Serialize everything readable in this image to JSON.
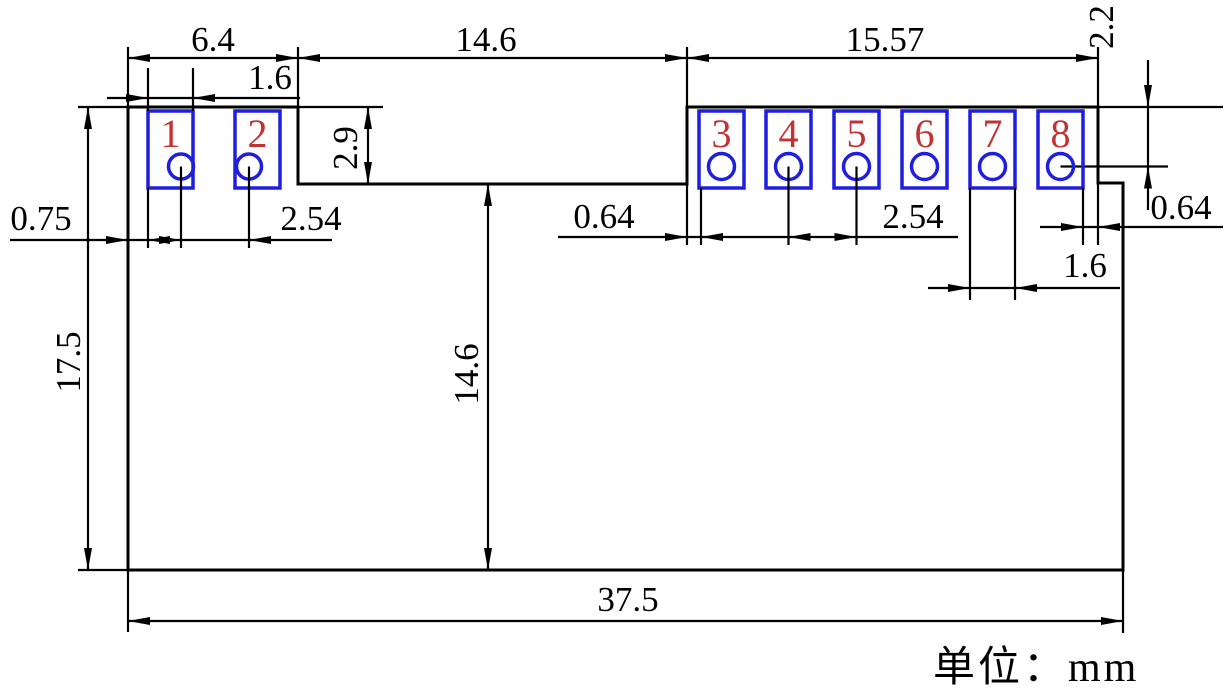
{
  "title": "pcb-module-dimension-drawing",
  "unit_note": "单位：mm",
  "colors": {
    "outline": "#000000",
    "pad_outline": "#1e1ee0",
    "pin_number": "#c23232",
    "background": "#ffffff"
  },
  "pins": [
    "1",
    "2",
    "3",
    "4",
    "5",
    "6",
    "7",
    "8"
  ],
  "dims": {
    "left_section_width": "6.4",
    "left_pad_width": "1.6",
    "middle_section_width": "14.6",
    "right_section_width": "15.57",
    "hole_offset_top": "2.2",
    "step_depth": "2.9",
    "edge_to_pad1": "0.75",
    "left_pitch": "2.54",
    "edge_to_pad3": "0.64",
    "right_pitch": "2.54",
    "pad8_edge_gap": "0.64",
    "right_pad_width": "1.6",
    "overall_height": "17.5",
    "middle_height": "14.6",
    "overall_width": "37.5"
  }
}
